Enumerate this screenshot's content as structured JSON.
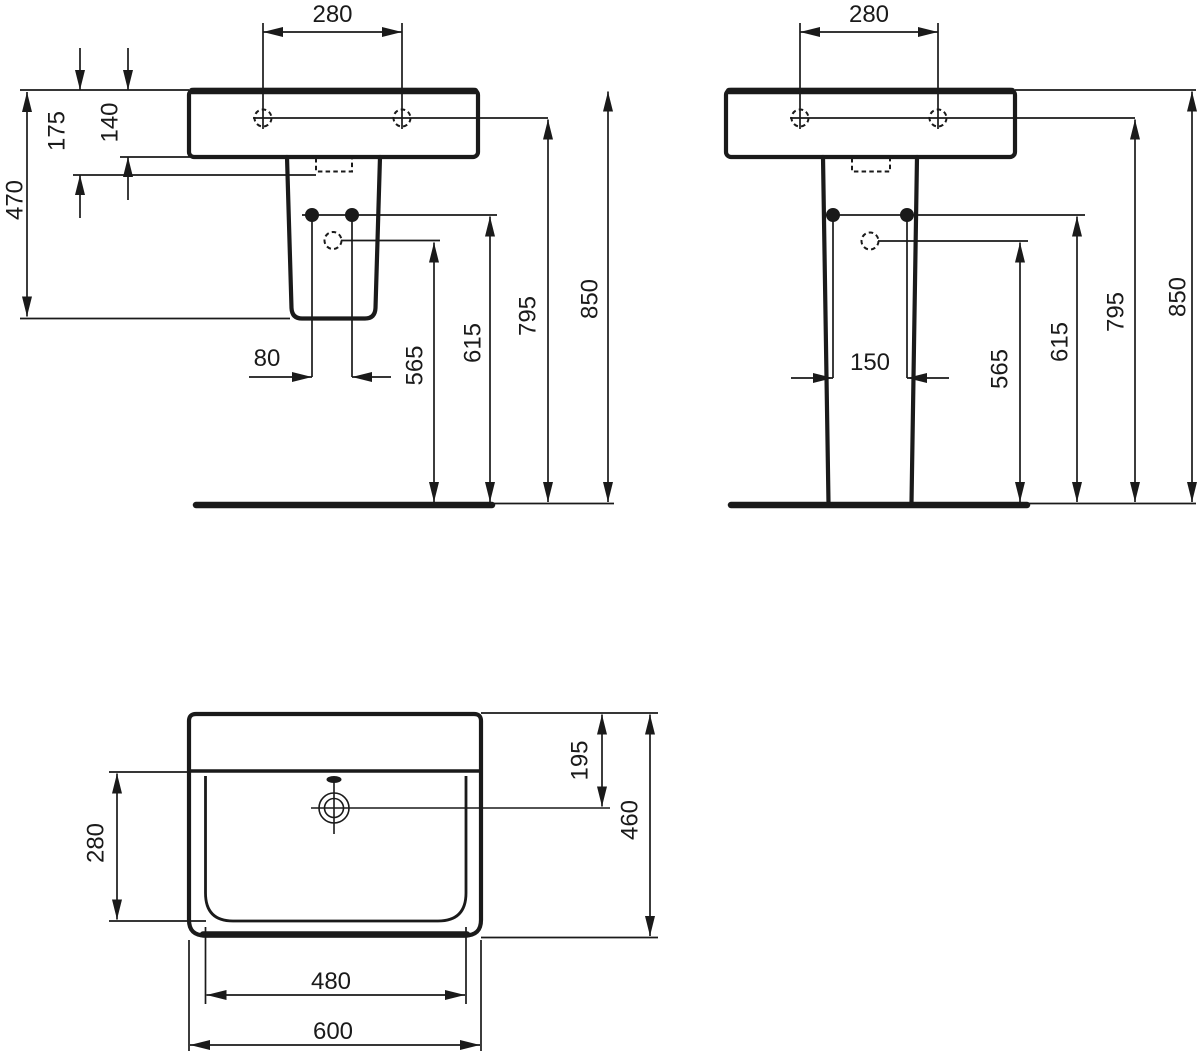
{
  "drawing": {
    "kind": "washbasin-installation-dimension-drawing",
    "ink_color": "#1a1a1a",
    "background_color": "#ffffff",
    "views": {
      "front_semi_pedestal": {
        "labels": {
          "hole_spacing": "280",
          "rim_to_drain": "175",
          "basin_height": "140",
          "semi_pedestal_bottom_height": "470",
          "fixing_hole_spacing": "80",
          "siphon_height": "565",
          "pedestal_fixing_height": "615",
          "hole_line_height": "795",
          "rim_height": "850"
        }
      },
      "front_full_pedestal": {
        "labels": {
          "hole_spacing": "280",
          "fixing_hole_spacing": "150",
          "siphon_height": "565",
          "pedestal_fixing_height": "615",
          "hole_line_height": "795",
          "rim_height": "850"
        }
      },
      "plan": {
        "labels": {
          "bowl_front_to_back": "280",
          "tap_center_offset": "195",
          "overall_depth": "460",
          "bowl_width": "480",
          "overall_width": "600"
        }
      }
    }
  }
}
